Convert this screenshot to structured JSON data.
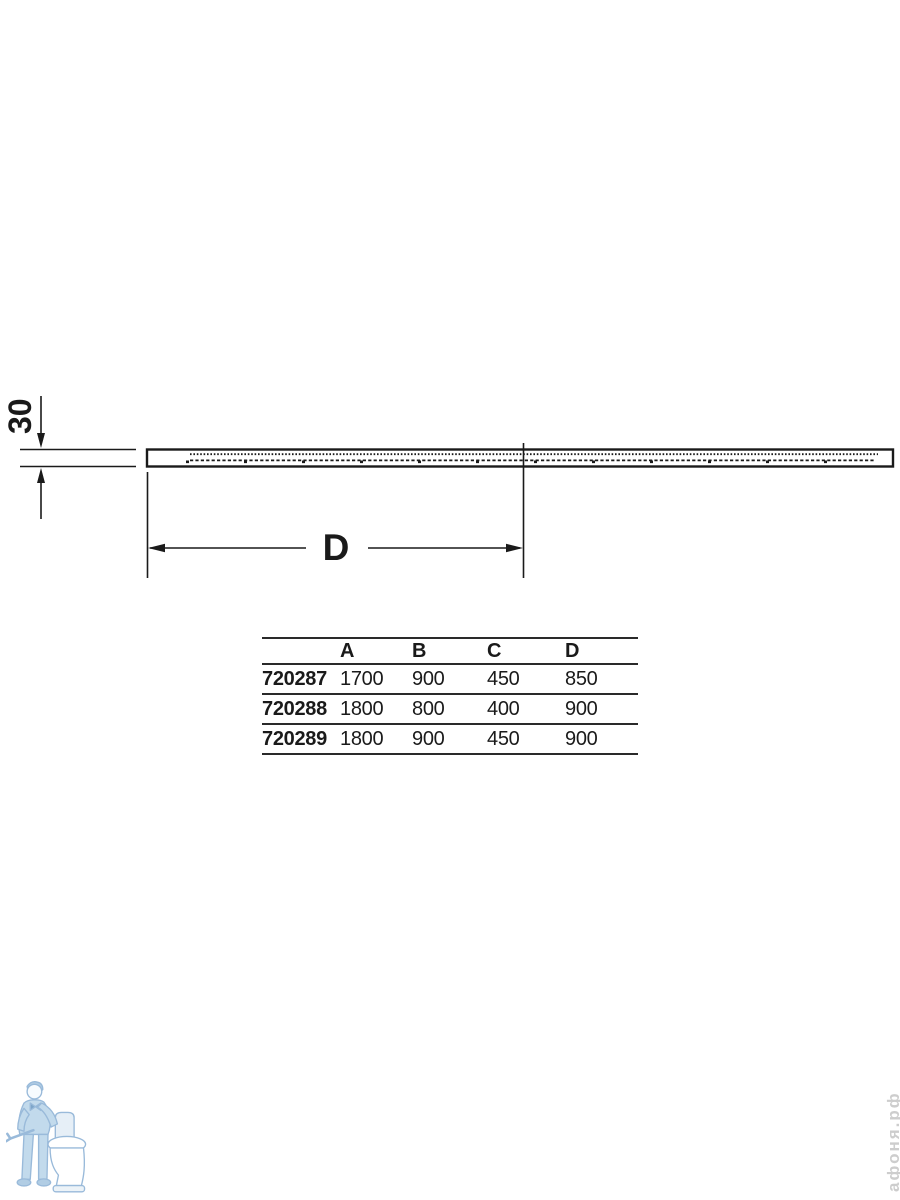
{
  "drawing": {
    "thickness_label": "30",
    "width_label": "D",
    "line_color": "#1a1a1a",
    "view": "shower-tray-side-profile"
  },
  "table": {
    "headers": [
      "",
      "A",
      "B",
      "C",
      "D"
    ],
    "rows": [
      [
        "720287",
        "1700",
        "900",
        "450",
        "850"
      ],
      [
        "720288",
        "1800",
        "800",
        "400",
        "900"
      ],
      [
        "720289",
        "1800",
        "900",
        "450",
        "900"
      ]
    ]
  },
  "watermark": {
    "text": "афоня.рф",
    "color": "#cdcdcd"
  },
  "logo": {
    "name": "plumber-with-toilet",
    "stroke": "#8fb3d6",
    "fill": "#bcd6ea"
  }
}
